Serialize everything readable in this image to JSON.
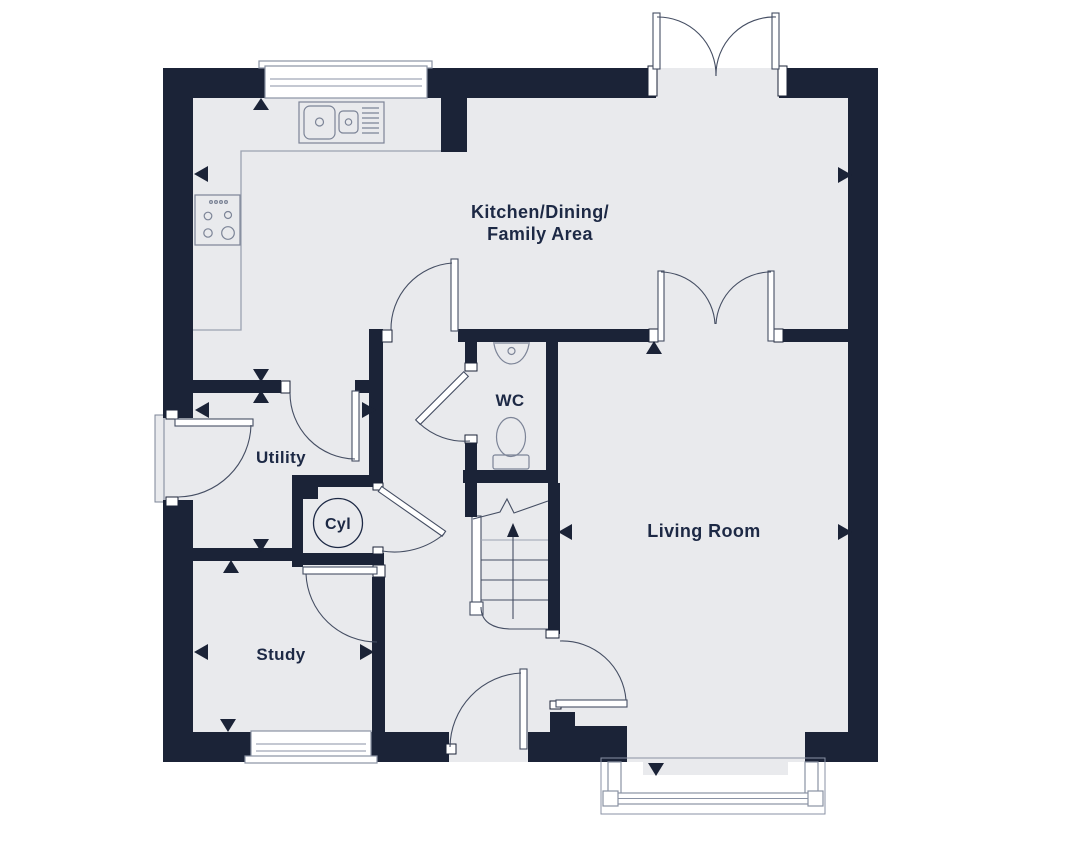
{
  "canvas": {
    "width": 1080,
    "height": 842
  },
  "colors": {
    "wall": "#1b2337",
    "floor": "#e9eaed",
    "door_line": "#454e63",
    "fixture_line": "#7c8497",
    "counter_line": "#9ba2b1",
    "window_frame": "#8a92a4",
    "label": "#1d2945"
  },
  "rooms": {
    "kitchen": {
      "name_line1": "Kitchen/Dining/",
      "name_line2": "Family Area"
    },
    "wc": {
      "name": "WC"
    },
    "utility": {
      "name": "Utility"
    },
    "cylinder": {
      "name": "Cyl"
    },
    "study": {
      "name": "Study"
    },
    "living_room": {
      "name": "Living Room"
    }
  }
}
